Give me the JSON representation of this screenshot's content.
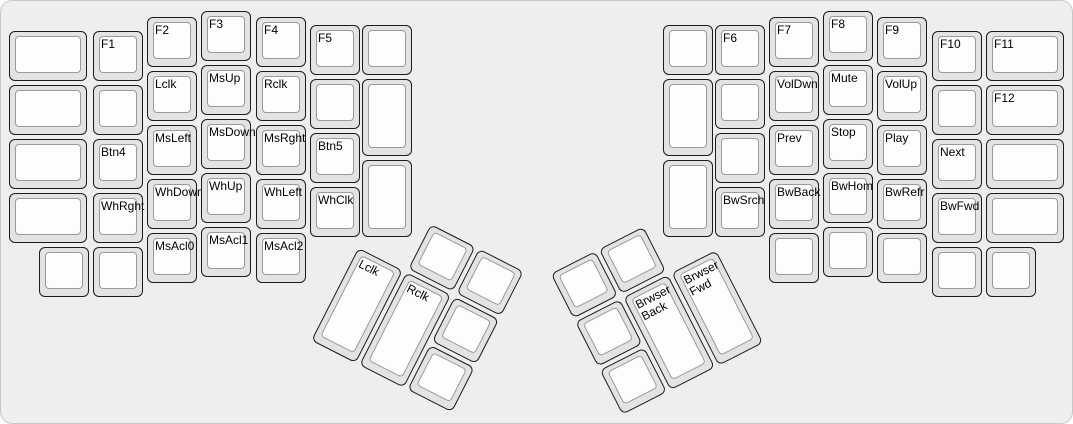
{
  "canvas": {
    "width": 1073,
    "height": 424,
    "background": "#eeeeee",
    "border_color": "#c7c7c7"
  },
  "key_colors": {
    "base_fill": "#e3e3e3",
    "base_border": "#1c1c1c",
    "top_fill": "#fdfdfd",
    "top_border": "#9a9a9a",
    "label_color": "#000000"
  },
  "groups": [
    {
      "name": "left-main",
      "rotation_deg": 0,
      "origin": {
        "x": 0,
        "y": 0
      },
      "keys": [
        {
          "label": "",
          "x": 8,
          "y": 30,
          "w": 78,
          "h": 50
        },
        {
          "label": "",
          "x": 8,
          "y": 84,
          "w": 78,
          "h": 50
        },
        {
          "label": "",
          "x": 8,
          "y": 138,
          "w": 78,
          "h": 50
        },
        {
          "label": "",
          "x": 8,
          "y": 192,
          "w": 78,
          "h": 50
        },
        {
          "label": "F1",
          "x": 92,
          "y": 30,
          "w": 50,
          "h": 50
        },
        {
          "label": "",
          "x": 92,
          "y": 84,
          "w": 50,
          "h": 50
        },
        {
          "label": "Btn4",
          "x": 92,
          "y": 138,
          "w": 50,
          "h": 50
        },
        {
          "label": "WhRght",
          "x": 92,
          "y": 192,
          "w": 50,
          "h": 50
        },
        {
          "label": "F2",
          "x": 146,
          "y": 16,
          "w": 50,
          "h": 50
        },
        {
          "label": "Lclk",
          "x": 146,
          "y": 70,
          "w": 50,
          "h": 50
        },
        {
          "label": "MsLeft",
          "x": 146,
          "y": 124,
          "w": 50,
          "h": 50
        },
        {
          "label": "WhDown",
          "x": 146,
          "y": 178,
          "w": 50,
          "h": 50
        },
        {
          "label": "MsAcl0",
          "x": 146,
          "y": 232,
          "w": 50,
          "h": 50
        },
        {
          "label": "F3",
          "x": 200,
          "y": 10,
          "w": 50,
          "h": 50
        },
        {
          "label": "MsUp",
          "x": 200,
          "y": 64,
          "w": 50,
          "h": 50
        },
        {
          "label": "MsDown",
          "x": 200,
          "y": 118,
          "w": 50,
          "h": 50
        },
        {
          "label": "WhUp",
          "x": 200,
          "y": 172,
          "w": 50,
          "h": 50
        },
        {
          "label": "MsAcl1",
          "x": 200,
          "y": 226,
          "w": 50,
          "h": 50
        },
        {
          "label": "F4",
          "x": 255,
          "y": 16,
          "w": 50,
          "h": 50
        },
        {
          "label": "Rclk",
          "x": 255,
          "y": 70,
          "w": 50,
          "h": 50
        },
        {
          "label": "MsRght",
          "x": 255,
          "y": 124,
          "w": 50,
          "h": 50
        },
        {
          "label": "WhLeft",
          "x": 255,
          "y": 178,
          "w": 50,
          "h": 50
        },
        {
          "label": "MsAcl2",
          "x": 255,
          "y": 232,
          "w": 50,
          "h": 50
        },
        {
          "label": "F5",
          "x": 309,
          "y": 24,
          "w": 50,
          "h": 50
        },
        {
          "label": "",
          "x": 309,
          "y": 78,
          "w": 50,
          "h": 50
        },
        {
          "label": "Btn5",
          "x": 309,
          "y": 132,
          "w": 50,
          "h": 50
        },
        {
          "label": "WhClk",
          "x": 309,
          "y": 186,
          "w": 50,
          "h": 50
        },
        {
          "label": "",
          "x": 361,
          "y": 24,
          "w": 50,
          "h": 50
        },
        {
          "label": "",
          "x": 361,
          "y": 78,
          "w": 50,
          "h": 77
        },
        {
          "label": "",
          "x": 361,
          "y": 159,
          "w": 50,
          "h": 77
        },
        {
          "label": "",
          "x": 38,
          "y": 246,
          "w": 50,
          "h": 50
        },
        {
          "label": "",
          "x": 92,
          "y": 246,
          "w": 50,
          "h": 50
        }
      ]
    },
    {
      "name": "left-thumb",
      "rotation_deg": 27,
      "origin": {
        "x": 381,
        "y": 196
      },
      "keys": [
        {
          "label": "",
          "x": 56,
          "y": 2,
          "w": 50,
          "h": 50
        },
        {
          "label": "",
          "x": 110,
          "y": 2,
          "w": 50,
          "h": 50
        },
        {
          "label": "Lclk",
          "x": 2,
          "y": 56,
          "w": 50,
          "h": 104
        },
        {
          "label": "Rclk",
          "x": 56,
          "y": 56,
          "w": 50,
          "h": 104
        },
        {
          "label": "",
          "x": 110,
          "y": 56,
          "w": 50,
          "h": 50
        },
        {
          "label": "",
          "x": 110,
          "y": 110,
          "w": 50,
          "h": 50
        }
      ]
    },
    {
      "name": "right-main",
      "rotation_deg": 0,
      "origin": {
        "x": 0,
        "y": 0
      },
      "keys": [
        {
          "label": "",
          "x": 662,
          "y": 24,
          "w": 50,
          "h": 50
        },
        {
          "label": "",
          "x": 662,
          "y": 78,
          "w": 50,
          "h": 77
        },
        {
          "label": "",
          "x": 662,
          "y": 159,
          "w": 50,
          "h": 77
        },
        {
          "label": "F6",
          "x": 714,
          "y": 24,
          "w": 50,
          "h": 50
        },
        {
          "label": "",
          "x": 714,
          "y": 78,
          "w": 50,
          "h": 50
        },
        {
          "label": "",
          "x": 714,
          "y": 132,
          "w": 50,
          "h": 50
        },
        {
          "label": "BwSrch",
          "x": 714,
          "y": 186,
          "w": 50,
          "h": 50
        },
        {
          "label": "F7",
          "x": 768,
          "y": 16,
          "w": 50,
          "h": 50
        },
        {
          "label": "VolDwn",
          "x": 768,
          "y": 70,
          "w": 50,
          "h": 50
        },
        {
          "label": "Prev",
          "x": 768,
          "y": 124,
          "w": 50,
          "h": 50
        },
        {
          "label": "BwBack",
          "x": 768,
          "y": 178,
          "w": 50,
          "h": 50
        },
        {
          "label": "",
          "x": 768,
          "y": 232,
          "w": 50,
          "h": 50
        },
        {
          "label": "F8",
          "x": 822,
          "y": 10,
          "w": 50,
          "h": 50
        },
        {
          "label": "Mute",
          "x": 822,
          "y": 64,
          "w": 50,
          "h": 50
        },
        {
          "label": "Stop",
          "x": 822,
          "y": 118,
          "w": 50,
          "h": 50
        },
        {
          "label": "BwHom",
          "x": 822,
          "y": 172,
          "w": 50,
          "h": 50
        },
        {
          "label": "",
          "x": 822,
          "y": 226,
          "w": 50,
          "h": 50
        },
        {
          "label": "F9",
          "x": 876,
          "y": 16,
          "w": 50,
          "h": 50
        },
        {
          "label": "VolUp",
          "x": 876,
          "y": 70,
          "w": 50,
          "h": 50
        },
        {
          "label": "Play",
          "x": 876,
          "y": 124,
          "w": 50,
          "h": 50
        },
        {
          "label": "BwRefr",
          "x": 876,
          "y": 178,
          "w": 50,
          "h": 50
        },
        {
          "label": "",
          "x": 876,
          "y": 232,
          "w": 50,
          "h": 50
        },
        {
          "label": "F10",
          "x": 931,
          "y": 30,
          "w": 50,
          "h": 50
        },
        {
          "label": "",
          "x": 931,
          "y": 84,
          "w": 50,
          "h": 50
        },
        {
          "label": "Next",
          "x": 931,
          "y": 138,
          "w": 50,
          "h": 50
        },
        {
          "label": "BwFwd",
          "x": 931,
          "y": 192,
          "w": 50,
          "h": 50
        },
        {
          "label": "",
          "x": 931,
          "y": 246,
          "w": 50,
          "h": 50
        },
        {
          "label": "F11",
          "x": 985,
          "y": 30,
          "w": 78,
          "h": 50
        },
        {
          "label": "F12",
          "x": 985,
          "y": 84,
          "w": 78,
          "h": 50
        },
        {
          "label": "",
          "x": 985,
          "y": 138,
          "w": 78,
          "h": 50
        },
        {
          "label": "",
          "x": 985,
          "y": 192,
          "w": 78,
          "h": 50
        },
        {
          "label": "",
          "x": 985,
          "y": 246,
          "w": 50,
          "h": 50
        }
      ]
    },
    {
      "name": "right-thumb",
      "rotation_deg": -27,
      "origin": {
        "x": 547,
        "y": 272
      },
      "keys": [
        {
          "label": "",
          "x": 2,
          "y": 2,
          "w": 50,
          "h": 50
        },
        {
          "label": "",
          "x": 56,
          "y": 2,
          "w": 50,
          "h": 50
        },
        {
          "label": "",
          "x": 2,
          "y": 56,
          "w": 50,
          "h": 50
        },
        {
          "label": "",
          "x": 2,
          "y": 110,
          "w": 50,
          "h": 50
        },
        {
          "label": "Brwser\nBack",
          "x": 56,
          "y": 56,
          "w": 50,
          "h": 104
        },
        {
          "label": "Brwser\nFwd",
          "x": 110,
          "y": 56,
          "w": 50,
          "h": 104
        }
      ]
    }
  ]
}
